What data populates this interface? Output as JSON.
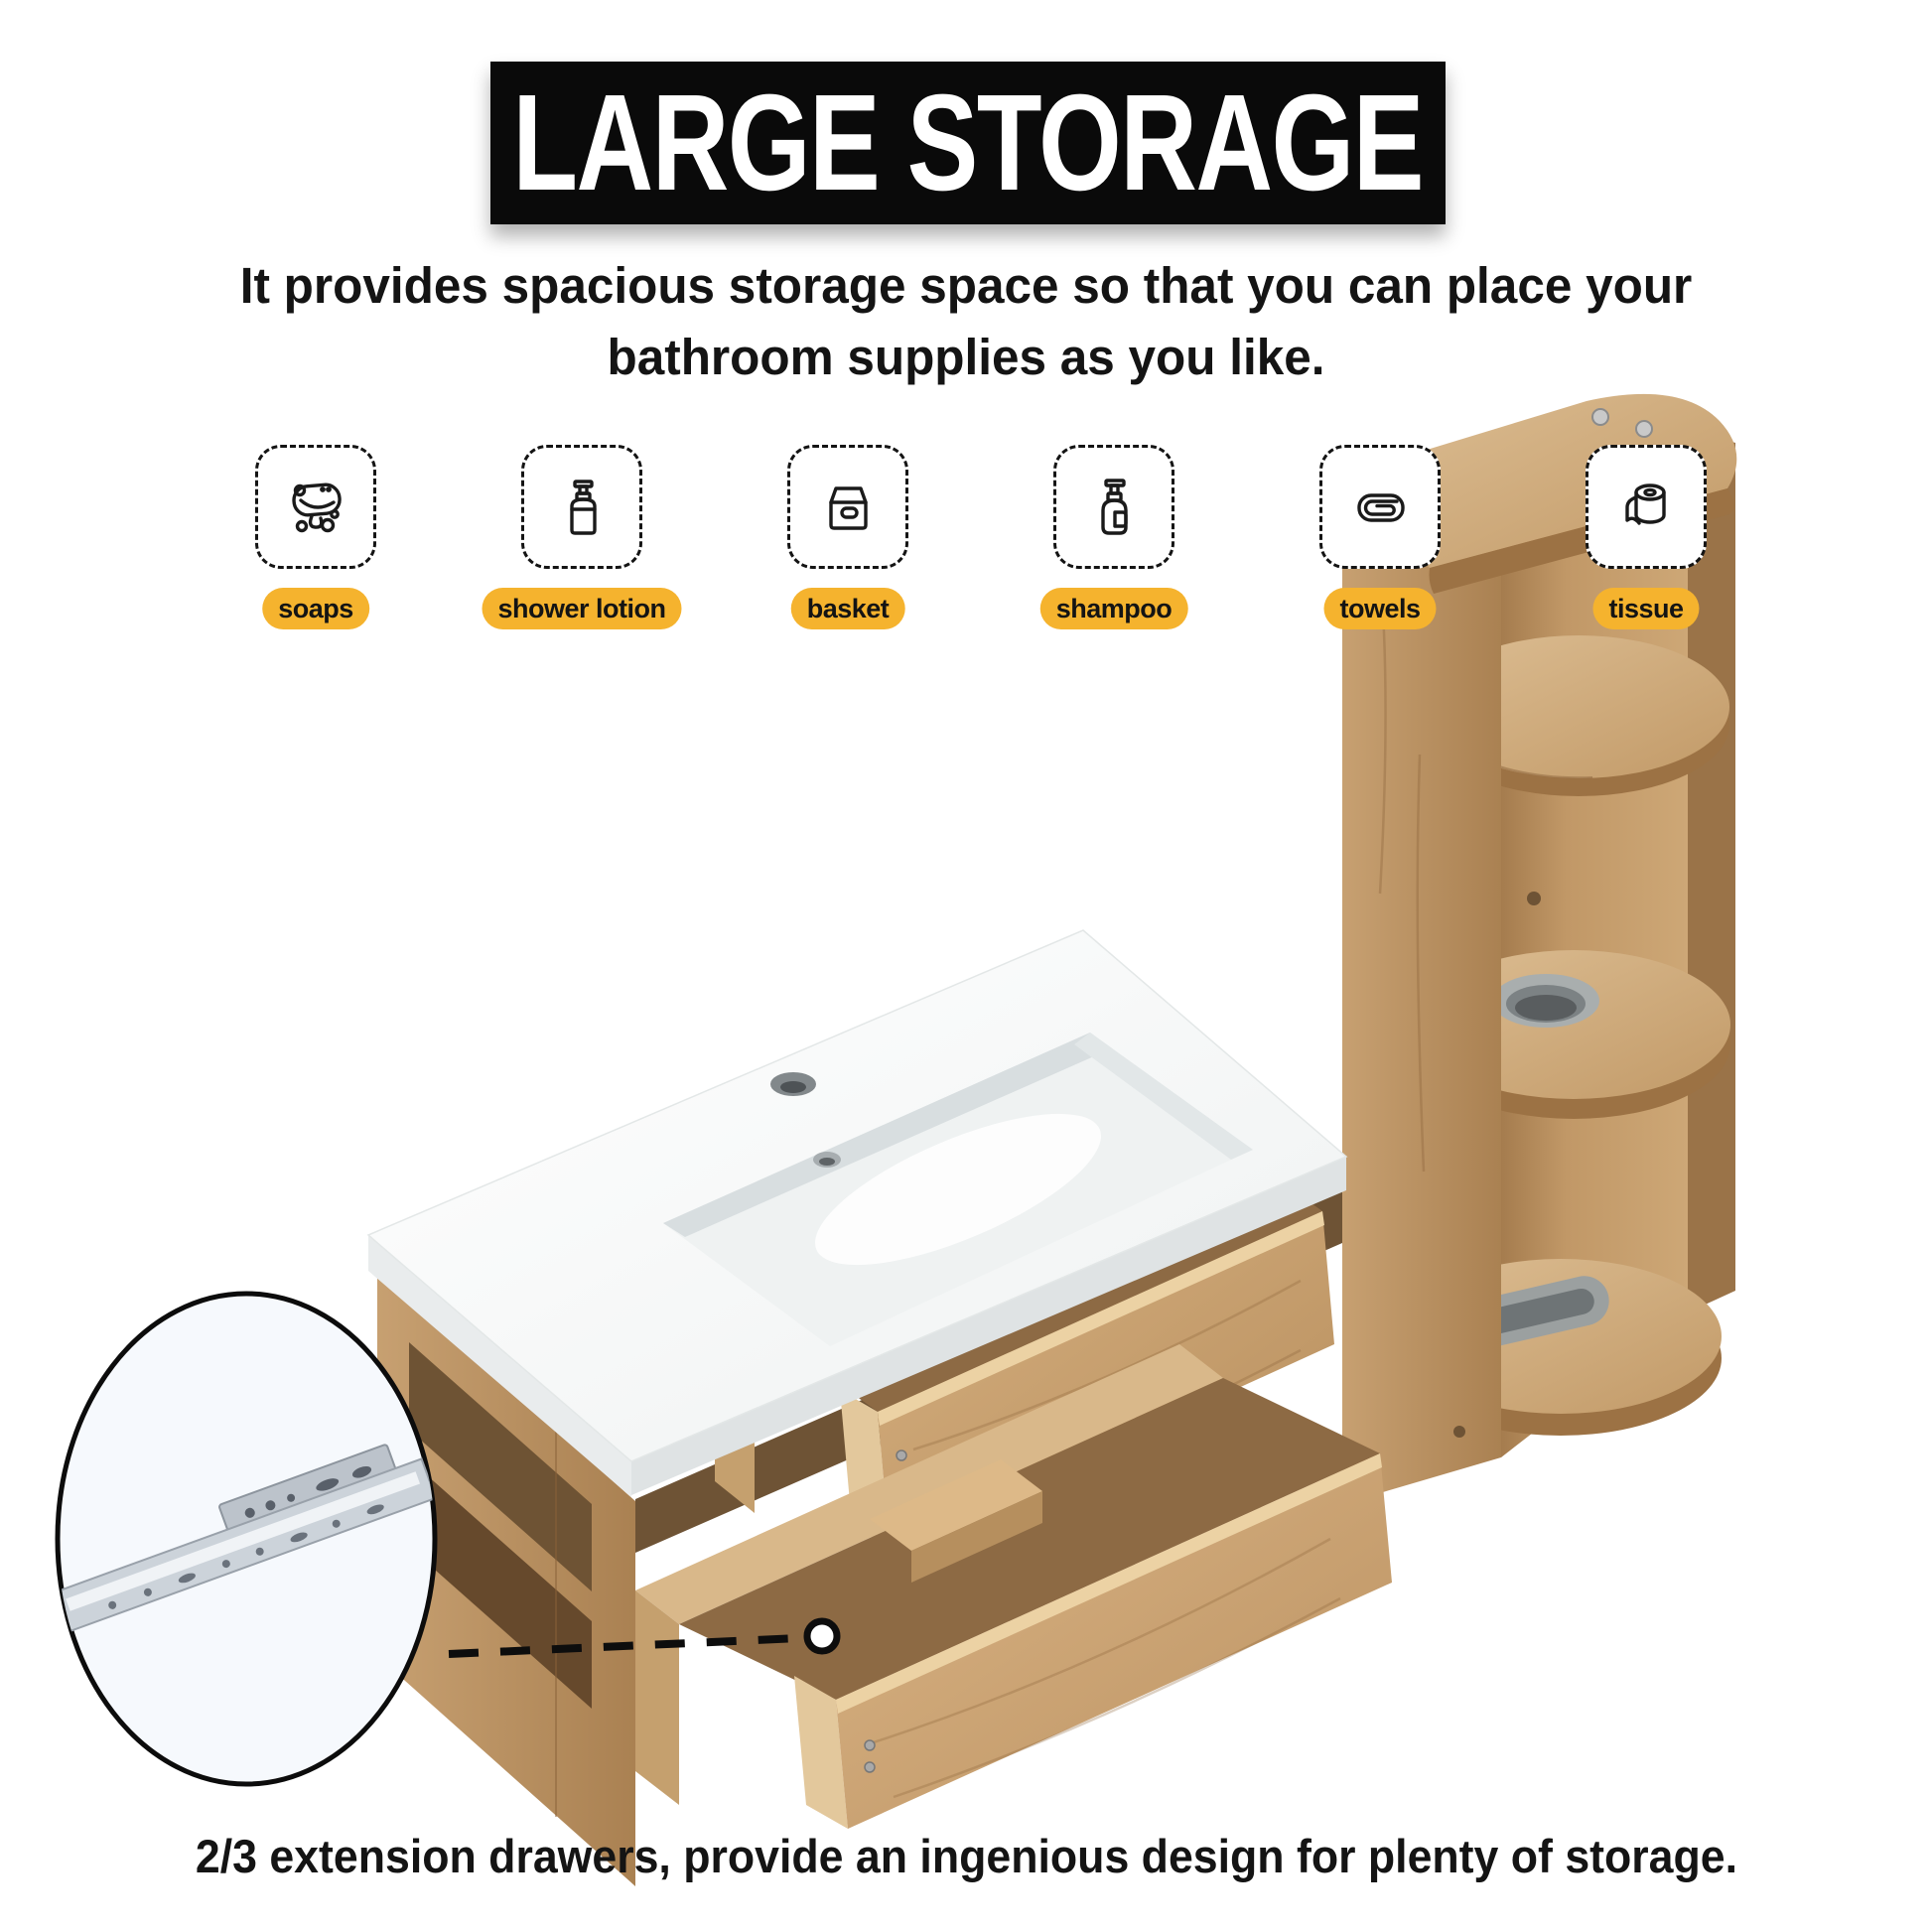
{
  "banner": {
    "title": "LARGE STORAGE",
    "bg": "#0A0A0A",
    "fg": "#FFFFFF"
  },
  "subtitle": {
    "line1": "It provides spacious storage space so that you can place your",
    "line2": "bathroom supplies as you like."
  },
  "features": [
    {
      "label": "soaps",
      "icon": "soap-icon"
    },
    {
      "label": "shower lotion",
      "icon": "shower-lotion-icon"
    },
    {
      "label": "basket",
      "icon": "basket-icon"
    },
    {
      "label": "shampoo",
      "icon": "shampoo-icon"
    },
    {
      "label": "towels",
      "icon": "towel-icon"
    },
    {
      "label": "tissue",
      "icon": "tissue-icon"
    }
  ],
  "caption": "2/3 extension drawers, provide an ingenious design for plenty of storage.",
  "colors": {
    "label_bg": "#F5B32E",
    "banner_bg": "#0A0A0A",
    "banner_fg": "#FFFFFF",
    "text": "#141414",
    "wood_light": "#D9B98E",
    "wood_base": "#C29B6C",
    "wood_dark": "#96744A",
    "wood_interior": "#6E5335",
    "ceramic": "#F7F8F8",
    "metal": "#C8CED5"
  },
  "illustration": {
    "subject": "oak wall-mounted bathroom vanity with white ceramic sink, two open extension drawers, right-side storage tower with round shelves, inset photo of metal drawer slide"
  }
}
